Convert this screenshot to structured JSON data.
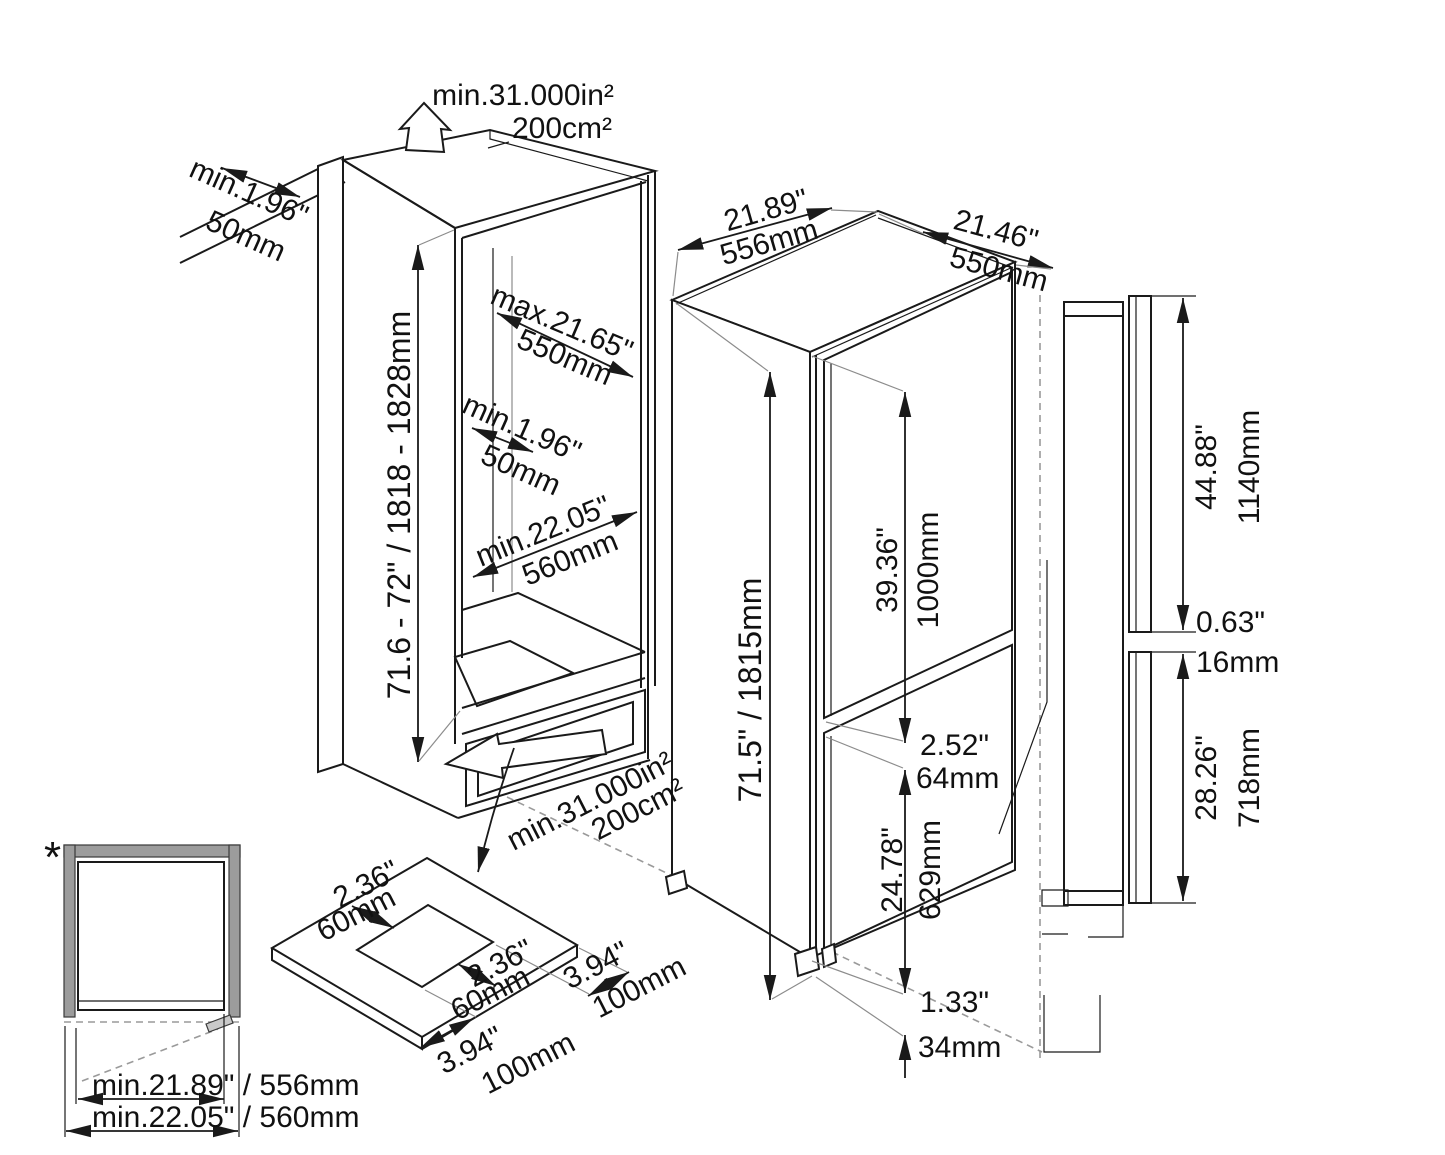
{
  "diagram": {
    "niche": {
      "top_vent_area_in": "min.31.000in²",
      "top_vent_area_cm": "200cm²",
      "rear_gap_in": "min.1.96\"",
      "rear_gap_mm": "50mm",
      "height_range": "71.6 - 72\" / 1818 - 1828mm",
      "depth_top_in": "max.21.65\"",
      "depth_top_mm": "550mm",
      "inner_gap_in": "min.1.96\"",
      "inner_gap_mm": "50mm",
      "depth_floor_in": "min.22.05\"",
      "depth_floor_mm": "560mm",
      "bottom_vent_area_in": "min.31.000in²",
      "bottom_vent_area_cm": "200cm²"
    },
    "fridge": {
      "width_in": "21.89\"",
      "width_mm": "556mm",
      "depth_in": "21.46\"",
      "depth_mm": "550mm",
      "height": "71.5\" / 1815mm",
      "upper_door_in": "39.36\"",
      "upper_door_mm": "1000mm",
      "gap_in": "2.52\"",
      "gap_mm": "64mm",
      "lower_door_in": "24.78\"",
      "lower_door_mm": "629mm",
      "foot_in": "1.33\"",
      "foot_mm": "34mm"
    },
    "panels": {
      "upper_in": "44.88\"",
      "upper_mm": "1140mm",
      "gap_in": "0.63\"",
      "gap_mm": "16mm",
      "lower_in": "28.26\"",
      "lower_mm": "718mm"
    },
    "base_plate": {
      "offset_in": "2.36\"",
      "offset_mm": "60mm",
      "cutout_in": "2.36\"",
      "cutout_mm": "60mm",
      "side_in": "3.94\"",
      "side_mm": "100mm",
      "front_in": "3.94\"",
      "front_mm": "100mm"
    },
    "plan_detail": {
      "marker": "*",
      "width_inner": "min.21.89\" / 556mm",
      "width_outer": "min.22.05\" / 560mm"
    }
  }
}
